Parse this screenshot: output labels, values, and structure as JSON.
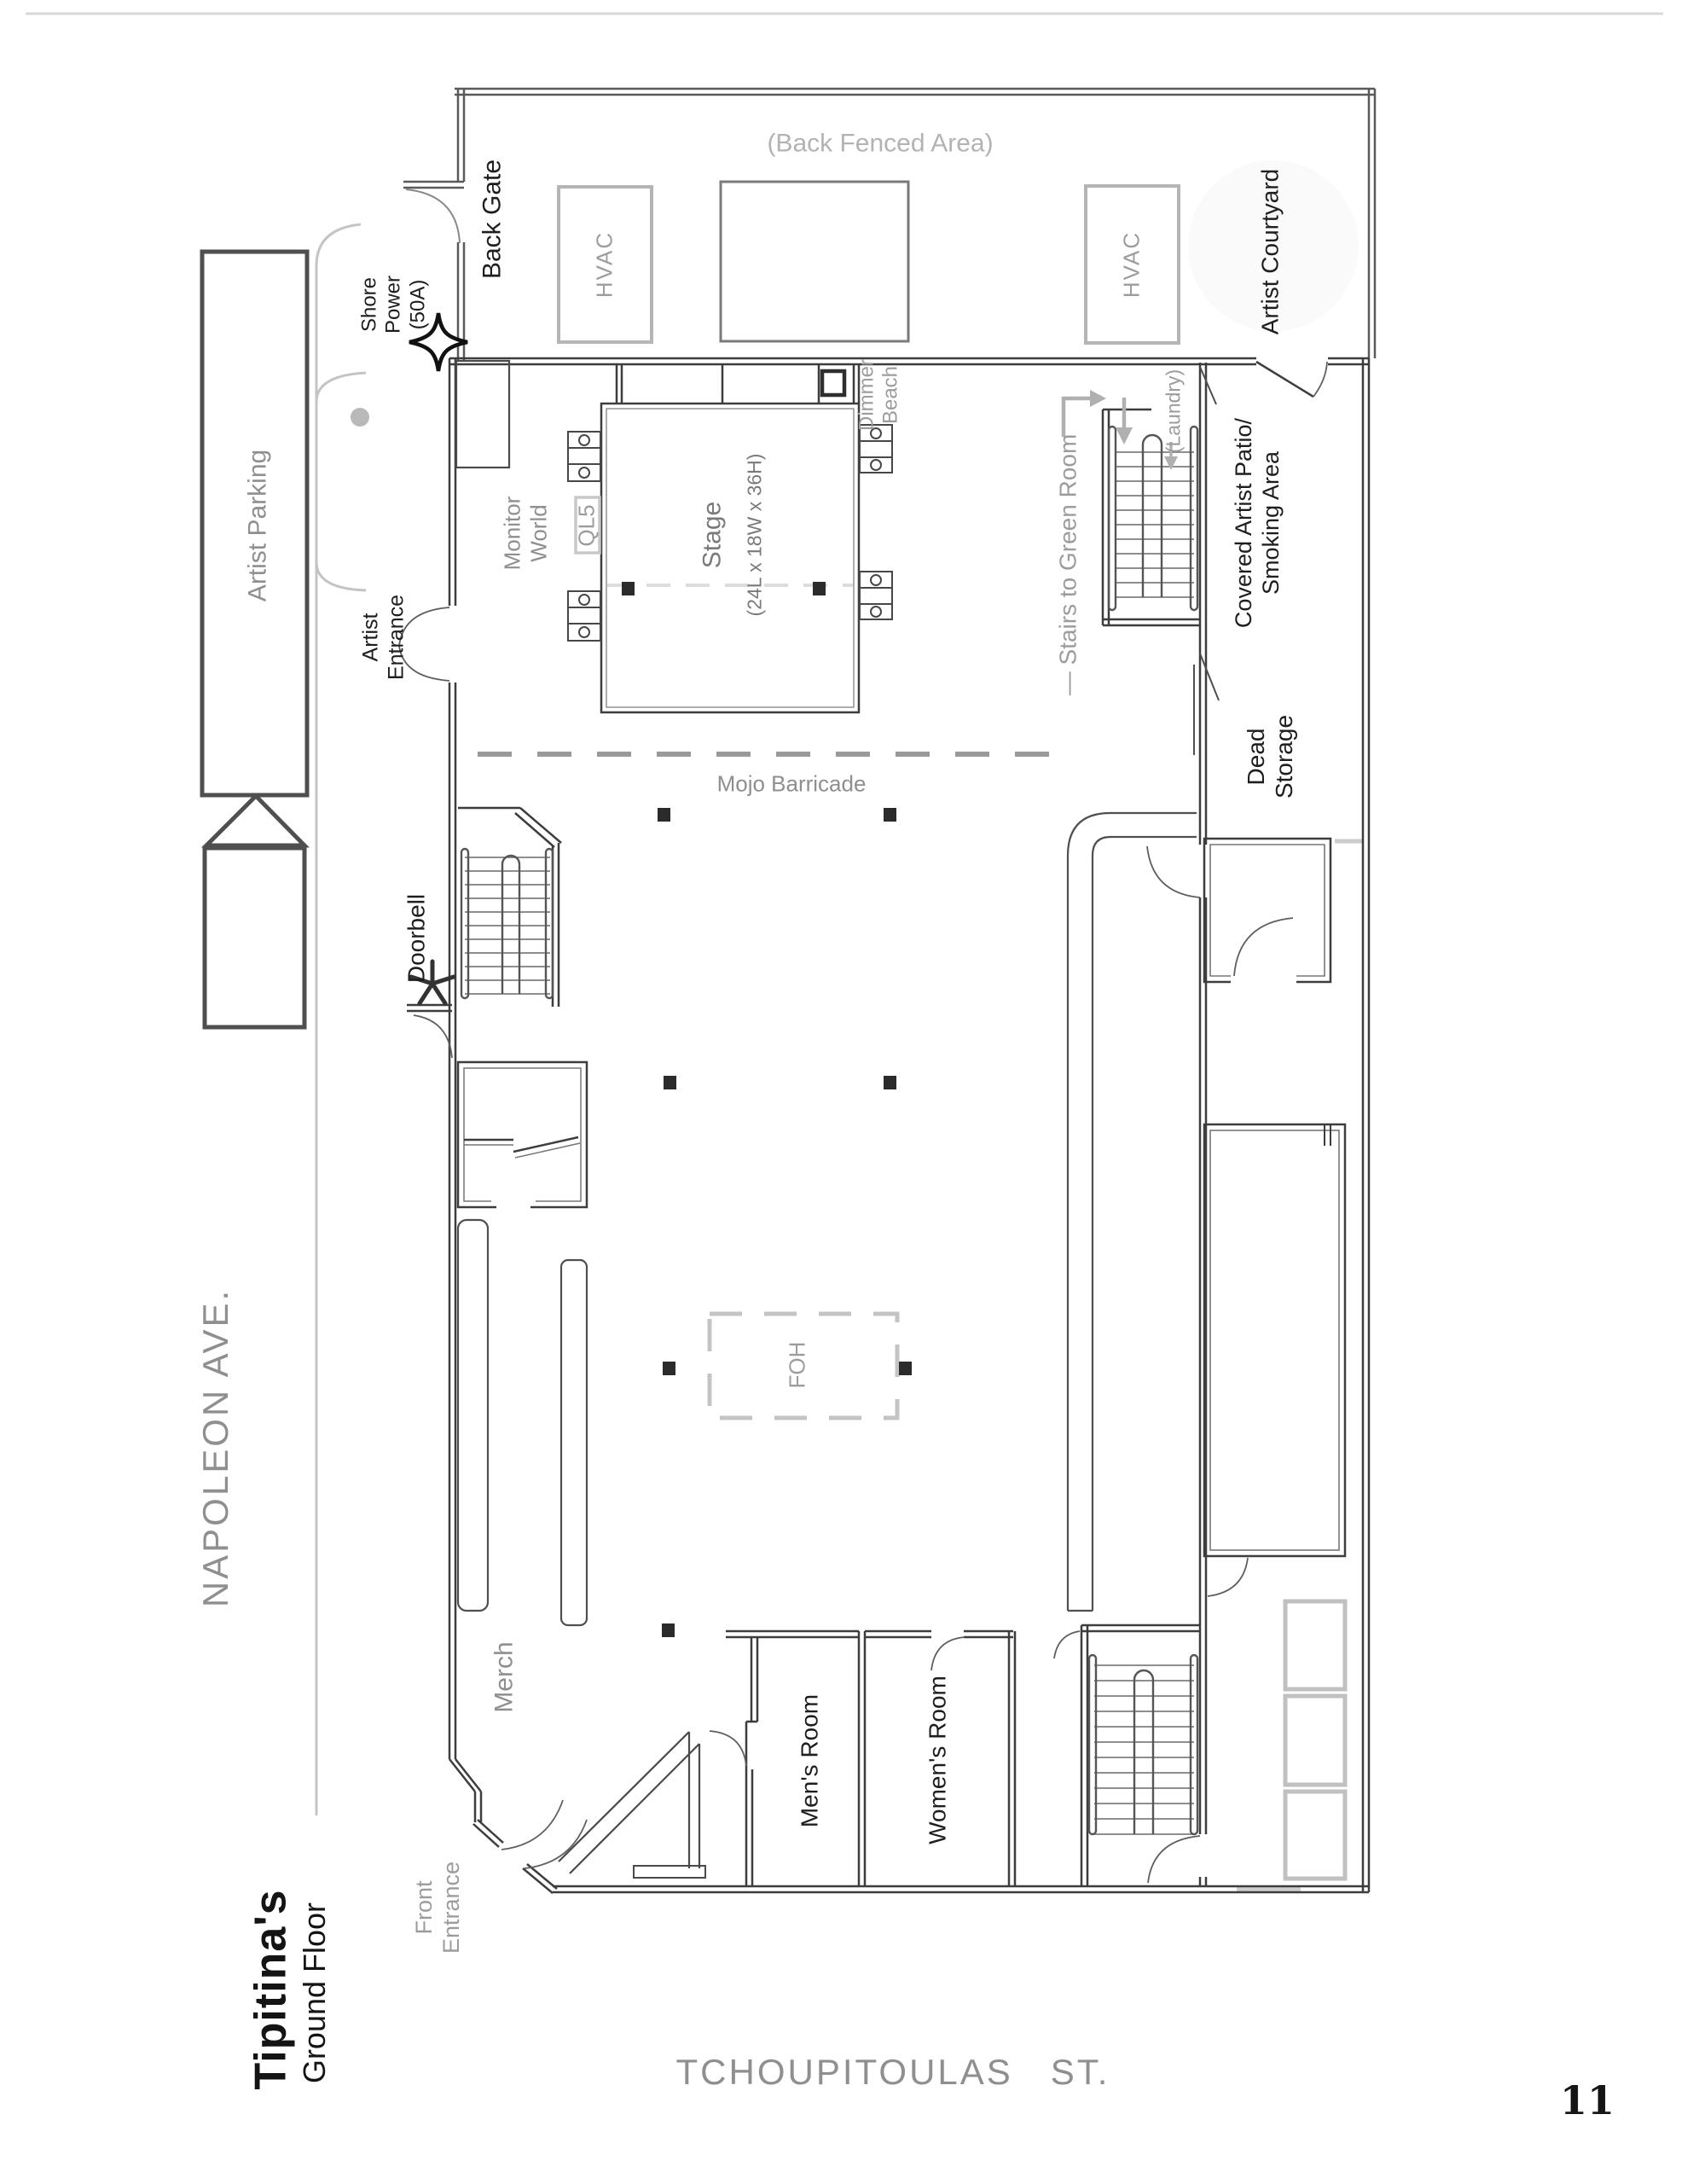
{
  "title": {
    "venue": "Tipitina's",
    "floor": "Ground Floor",
    "page_number": "11"
  },
  "streets": {
    "left": "NAPOLEON AVE.",
    "bottom": "TCHOUPITOULAS   ST."
  },
  "labels": {
    "back_fenced_area": "(Back Fenced Area)",
    "back_gate": "Back Gate",
    "shore_power": "Shore\nPower\n(50A)",
    "hvac": "HVAC",
    "artist_courtyard": "Artist Courtyard",
    "artist_parking": "Artist Parking",
    "artist_entrance": "Artist\nEntrance",
    "monitor_world": "Monitor\nWorld",
    "ql5": "QL5",
    "stage_name": "Stage",
    "stage_dims": "(24L x 18W x 36H)",
    "dimmer_beach": "Dimmer\nBeach",
    "stairs_green_room": "— Stairs to Green Room",
    "laundry": "(Laundry)",
    "covered_patio": "Covered Artist Patio/\nSmoking Area",
    "dead_storage": "Dead\nStorage",
    "mojo_barricade": "Mojo Barricade",
    "foh": "FOH",
    "doorbell": "Doorbell",
    "merch": "Merch",
    "mens_room": "Men's Room",
    "womens_room": "Women's Room",
    "front_entrance": "Front\nEntrance"
  },
  "colors": {
    "wall": "#3d3d3d",
    "site_gray": "#c4c4c4",
    "label_gray": "#8f8f8f",
    "label_dark": "#1e1e1e"
  }
}
